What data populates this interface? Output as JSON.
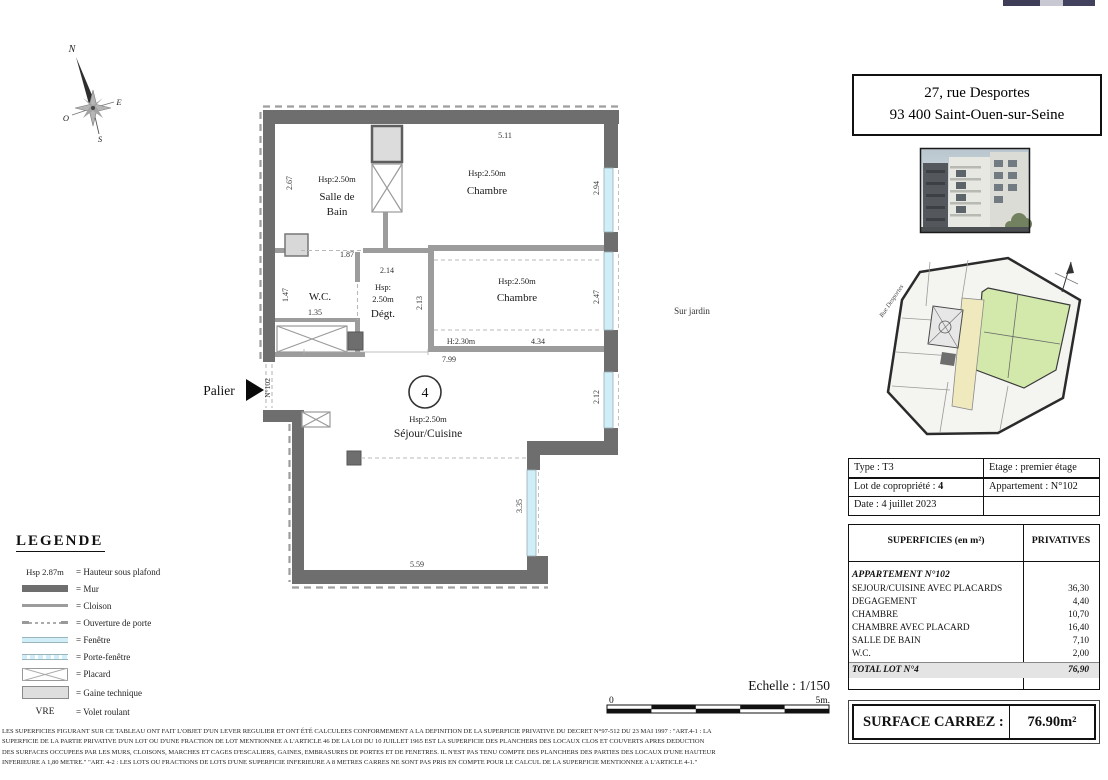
{
  "address_box": {
    "line1": "27, rue Desportes",
    "line2": "93 400 Saint-Ouen-sur-Seine"
  },
  "compass": {
    "north": "N",
    "east": "E",
    "west": "O",
    "south": "S"
  },
  "plan": {
    "rooms": {
      "salle_de_bain_hsp": "Hsp:2.50m",
      "salle_de_bain_1": "Salle de",
      "salle_de_bain_2": "Bain",
      "chambre_top_hsp": "Hsp:2.50m",
      "chambre_top": "Chambre",
      "wc": "W.C.",
      "degagement_hsp_1": "Hsp:",
      "degagement_hsp_2": "2.50m",
      "degagement": "Dégt.",
      "chambre_mid_hsp": "Hsp:2.50m",
      "chambre_mid": "Chambre",
      "sejour_lot": "4",
      "sejour_hsp": "Hsp:2.50m",
      "sejour": "Séjour/Cuisine"
    },
    "dims": {
      "top_width": "5.11",
      "sdb_height": "2.67",
      "win_chambre_top": "2.94",
      "sdb_width": "1.87",
      "degt_width": "2.14",
      "wc_height": "1.47",
      "wc_width": "1.35",
      "degt_height": "2.13",
      "win_chambre_mid": "2.47",
      "soffit_height": "H:2.30m",
      "chambre_mid_width": "4.34",
      "sejour_top_width": "7.99",
      "win_sejour_right": "2.12",
      "win_sejour_door": "3.35",
      "sejour_bottom_width": "5.59"
    },
    "labels": {
      "palier": "Palier",
      "door_number": "N°102",
      "garden": "Sur jardin"
    }
  },
  "key_plan": {
    "street": "Rue Desportes"
  },
  "info_table": {
    "type": "Type : T3",
    "etage": "Etage : premier étage",
    "lot_label": "Lot de copropriété : ",
    "lot_value": "4",
    "appartement": "Appartement : N°102",
    "date": "Date : 4 juillet 2023"
  },
  "superficies_table": {
    "header_left": "SUPERFICIES (en m²)",
    "header_right": "PRIVATIVES",
    "group_title": "APPARTEMENT N°102",
    "rows": [
      {
        "label": "SEJOUR/CUISINE AVEC PLACARDS",
        "value": "36,30"
      },
      {
        "label": "DEGAGEMENT",
        "value": "4,40"
      },
      {
        "label": "CHAMBRE",
        "value": "10,70"
      },
      {
        "label": "CHAMBRE AVEC PLACARD",
        "value": "16,40"
      },
      {
        "label": "SALLE DE BAIN",
        "value": "7,10"
      },
      {
        "label": "W.C.",
        "value": "2,00"
      }
    ],
    "total_label": "TOTAL LOT N°4",
    "total_value": "76,90"
  },
  "surface_carrez": {
    "label": "SURFACE CARREZ :",
    "value": "76.90m²"
  },
  "legend": {
    "title": "LEGENDE",
    "hsp_key": "Hsp 2.87m",
    "vre_key": "VRE",
    "labels": [
      "= Hauteur sous plafond",
      "= Mur",
      "= Cloison",
      "= Ouverture de porte",
      "= Fenêtre",
      "= Porte-fenêtre",
      "= Placard",
      "= Gaine technique",
      "= Volet roulant"
    ]
  },
  "scale_bar": {
    "title": "Echelle : 1/150",
    "start": "0",
    "end": "5m."
  },
  "disclaimer": {
    "lines": [
      "LES SUPERFICIES FIGURANT SUR CE TABLEAU ONT FAIT L'OBJET D'UN LEVER REGULIER ET ONT ÉTÉ CALCULEES CONFORMEMENT A LA DEFINITION DE LA SUPERFICIE PRIVATIVE DU DECRET N°97-512 DU 23 MAI 1997 : \"ART.4-1 : LA",
      "SUPERFICIE DE LA PARTIE PRIVATIVE D'UN LOT OU D'UNE FRACTION DE LOT MENTIONNEE A L'ARTICLE 46 DE LA LOI DU 10 JUILLET 1965 EST LA SUPERFICIE DES PLANCHERS DES LOCAUX CLOS ET COUVERTS APRES DEDUCTION",
      "DES SURFACES OCCUPEES PAR LES MURS, CLOISONS, MARCHES ET CAGES D'ESCALIERS, GAINES, EMBRASURES DE PORTES ET DE FENETRES. IL N'EST PAS TENU COMPTE DES PLANCHERS DES PARTIES DES LOCAUX D'UNE HAUTEUR",
      "INFERIEURE A 1,80 METRE.\"   \"ART. 4-2 : LES LOTS OU FRACTIONS DE LOTS D'UNE SUPERFICIE INFERIEURE A 8 METRES CARRES NE SONT PAS PRIS EN COMPTE POUR LE CALCUL DE LA SUPERFICIE MENTIONNEE A L'ARTICLE 4-1.\""
    ]
  }
}
